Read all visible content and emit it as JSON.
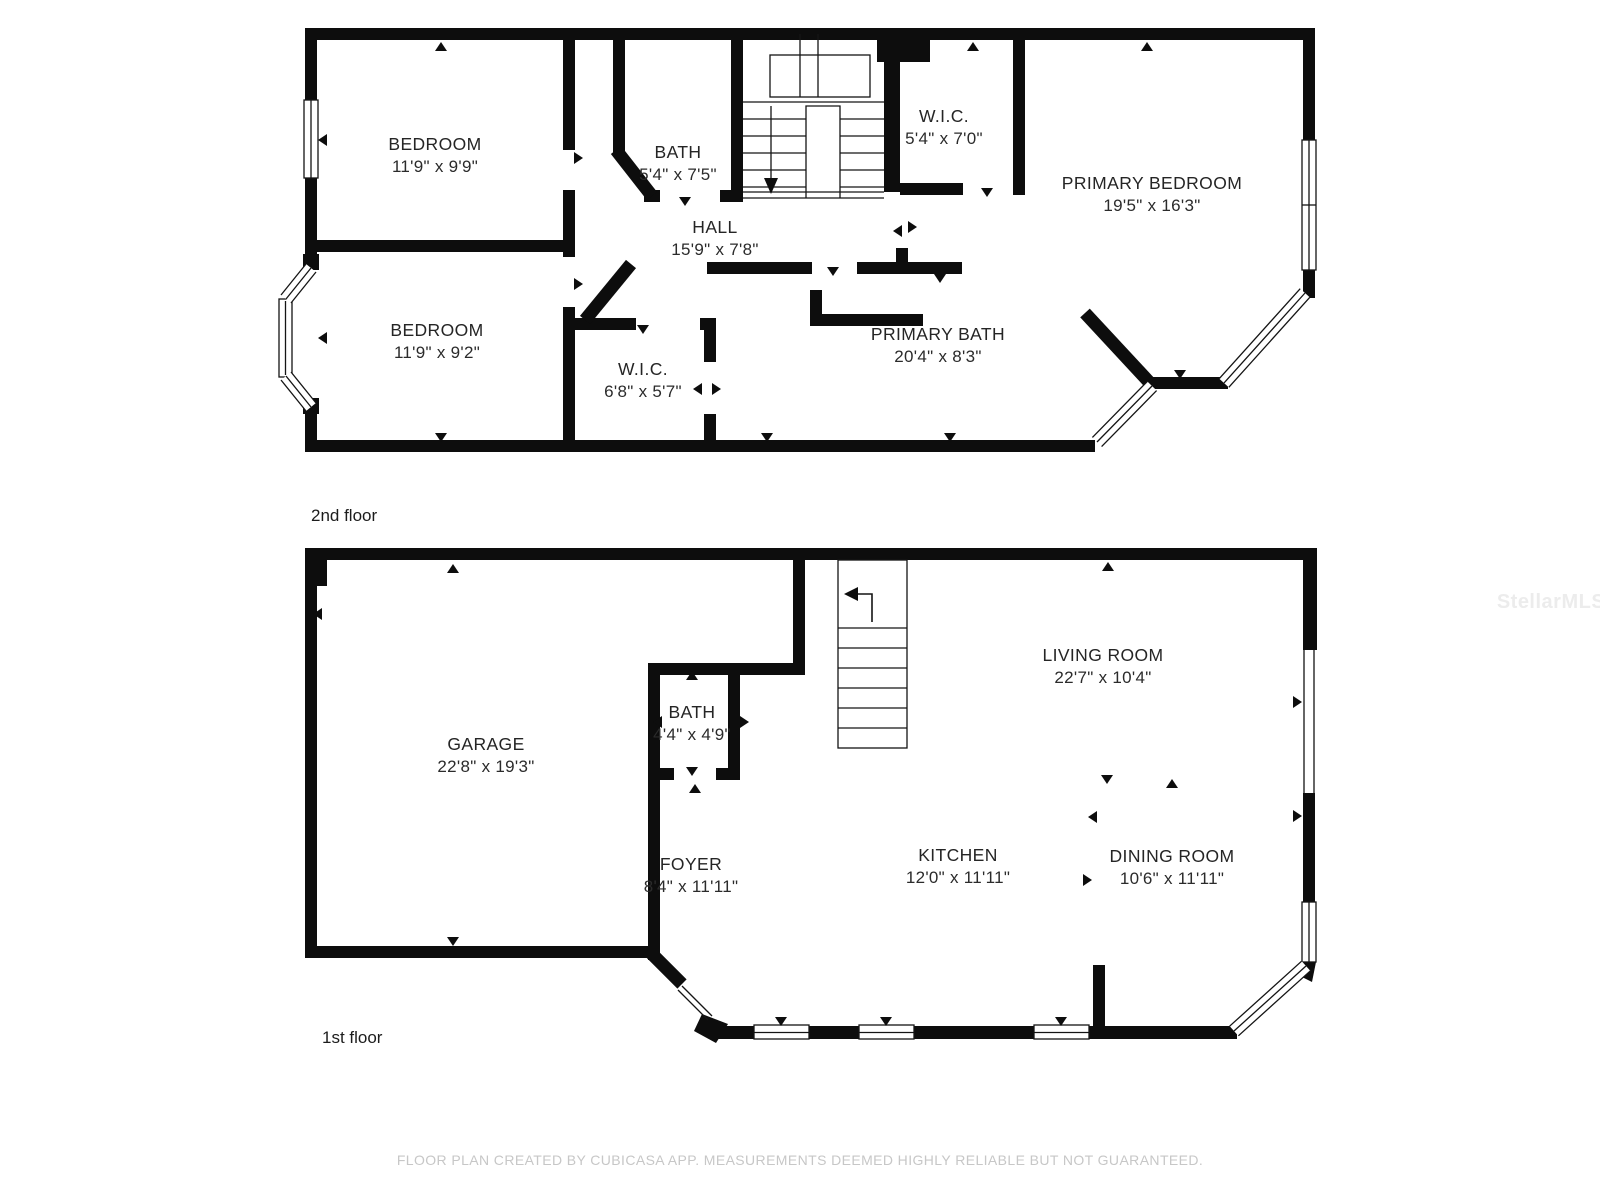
{
  "floors": [
    {
      "label": "2nd floor",
      "rooms": [
        {
          "name": "BEDROOM",
          "dims": "11'9\" x 9'9\""
        },
        {
          "name": "BATH",
          "dims": "5'4\" x 7'5\""
        },
        {
          "name": "W.I.C.",
          "dims": "5'4\" x 7'0\""
        },
        {
          "name": "PRIMARY BEDROOM",
          "dims": "19'5\" x 16'3\""
        },
        {
          "name": "HALL",
          "dims": "15'9\" x 7'8\""
        },
        {
          "name": "BEDROOM",
          "dims": "11'9\" x 9'2\""
        },
        {
          "name": "W.I.C.",
          "dims": "6'8\" x 5'7\""
        },
        {
          "name": "PRIMARY BATH",
          "dims": "20'4\" x 8'3\""
        }
      ]
    },
    {
      "label": "1st floor",
      "rooms": [
        {
          "name": "GARAGE",
          "dims": "22'8\" x 19'3\""
        },
        {
          "name": "BATH",
          "dims": "4'4\" x 4'9\""
        },
        {
          "name": "LIVING ROOM",
          "dims": "22'7\" x 10'4\""
        },
        {
          "name": "FOYER",
          "dims": "8'4\" x 11'11\""
        },
        {
          "name": "KITCHEN",
          "dims": "12'0\" x 11'11\""
        },
        {
          "name": "DINING ROOM",
          "dims": "10'6\" x 11'11\""
        }
      ]
    }
  ],
  "watermark": "StellarMLS",
  "footer": "FLOOR PLAN CREATED BY CUBICASA APP. MEASUREMENTS DEEMED HIGHLY RELIABLE BUT NOT GUARANTEED.",
  "colors": {
    "wall": "#0d0d0d",
    "text": "#252525",
    "footer": "#c7c7c7",
    "watermark": "#ececec",
    "background": "#ffffff"
  }
}
